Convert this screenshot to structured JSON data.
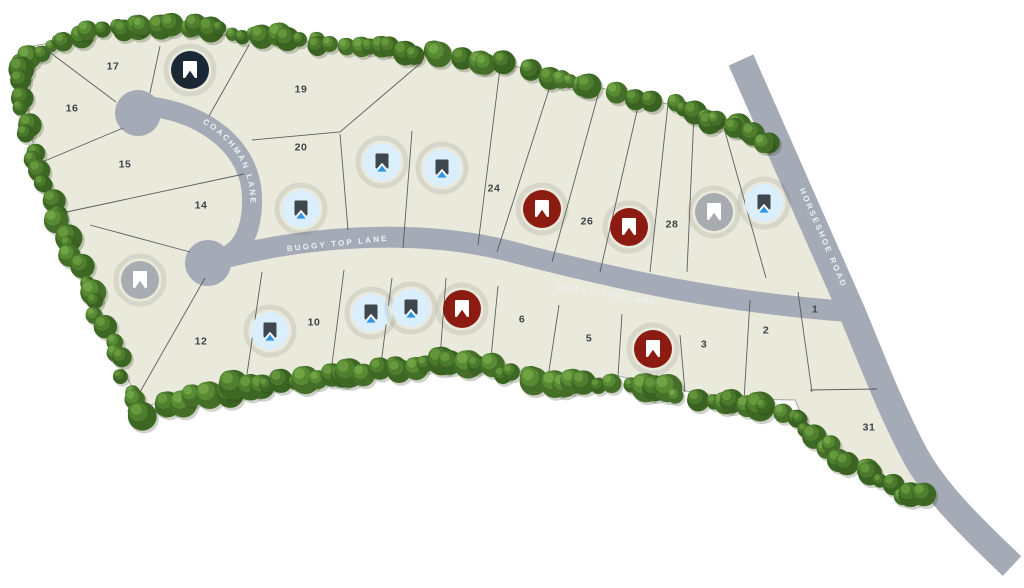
{
  "page": {
    "background": "#ffffff"
  },
  "map": {
    "land_color": "#e9e9dc",
    "land_outline_color": "#5a5e58",
    "road_color": "#a4aab6",
    "road_label_color": "#eef1f5",
    "lot_line_color": "#4b5052",
    "lot_label_color": "#3d4344"
  },
  "roads": {
    "coachman": {
      "label": "COACHMAN LANE"
    },
    "buggy_top_upper": {
      "label": "BUGGY TOP LANE"
    },
    "buggy_top_lower": {
      "label": "BUGGY TOP LANE"
    },
    "horseshoe": {
      "label": "HORSESHOE ROAD"
    }
  },
  "marker_styles": {
    "navy": {
      "circle": "#1a2836",
      "icon": "#ffffff"
    },
    "red": {
      "circle": "#8c1c12",
      "icon": "#ffffff"
    },
    "gray": {
      "circle": "#a8acb1",
      "icon": "#ffffff"
    },
    "blue": {
      "circle": "#dbeefc",
      "icon": "#3f464d",
      "chevron": "#ffffff",
      "accent": "#2f95e0"
    }
  },
  "lots": [
    {
      "number": "17",
      "x": 113,
      "y": 66
    },
    {
      "number": "19",
      "x": 301,
      "y": 89
    },
    {
      "number": "16",
      "x": 72,
      "y": 108
    },
    {
      "number": "20",
      "x": 301,
      "y": 147
    },
    {
      "number": "15",
      "x": 125,
      "y": 164
    },
    {
      "number": "24",
      "x": 494,
      "y": 188
    },
    {
      "number": "14",
      "x": 201,
      "y": 205
    },
    {
      "number": "26",
      "x": 587,
      "y": 221
    },
    {
      "number": "28",
      "x": 672,
      "y": 224
    },
    {
      "number": "12",
      "x": 201,
      "y": 341
    },
    {
      "number": "10",
      "x": 314,
      "y": 322
    },
    {
      "number": "6",
      "x": 522,
      "y": 319
    },
    {
      "number": "5",
      "x": 589,
      "y": 338
    },
    {
      "number": "3",
      "x": 704,
      "y": 344
    },
    {
      "number": "2",
      "x": 766,
      "y": 330
    },
    {
      "number": "1",
      "x": 815,
      "y": 309
    },
    {
      "number": "31",
      "x": 869,
      "y": 427
    }
  ],
  "markers": [
    {
      "variant": "navy",
      "x": 190,
      "y": 70
    },
    {
      "variant": "blue",
      "x": 382,
      "y": 162
    },
    {
      "variant": "blue",
      "x": 442,
      "y": 168
    },
    {
      "variant": "blue",
      "x": 301,
      "y": 209
    },
    {
      "variant": "red",
      "x": 542,
      "y": 209
    },
    {
      "variant": "red",
      "x": 629,
      "y": 227
    },
    {
      "variant": "gray",
      "x": 714,
      "y": 212
    },
    {
      "variant": "blue",
      "x": 764,
      "y": 203
    },
    {
      "variant": "gray",
      "x": 140,
      "y": 280
    },
    {
      "variant": "blue",
      "x": 270,
      "y": 331
    },
    {
      "variant": "blue",
      "x": 371,
      "y": 313
    },
    {
      "variant": "blue",
      "x": 411,
      "y": 308
    },
    {
      "variant": "red",
      "x": 462,
      "y": 309
    },
    {
      "variant": "red",
      "x": 653,
      "y": 349
    }
  ]
}
